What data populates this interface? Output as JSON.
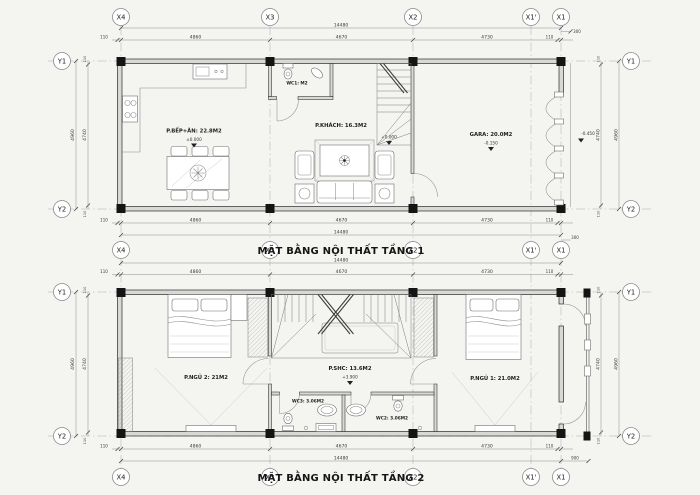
{
  "drawing": {
    "floor1": {
      "title": "MẶT BẰNG NỘI THẤT TẦNG 1",
      "rooms": {
        "kitchen": {
          "label": "P.BẾP+ĂN: 22.8M2",
          "elevation": "±0.000"
        },
        "wc1": {
          "label": "WC1: M2"
        },
        "living": {
          "label": "P.KHÁCH: 16.3M2",
          "elevation": "+0.000"
        },
        "garage": {
          "label": "GARA: 20.0M2",
          "elevation": "-0.150"
        }
      },
      "outside_elevation": "-0.450",
      "front_offset": "300"
    },
    "floor2": {
      "title": "MẶT BẰNG NỘI THẤT TẦNG 2",
      "rooms": {
        "bedroom2": {
          "label": "P.NGỦ 2: 21M2"
        },
        "family": {
          "label": "P.SHC: 13.6M2",
          "elevation": "+3.900"
        },
        "wc3": {
          "label": "WC3: 3.06M2"
        },
        "wc2": {
          "label": "WC2: 3.06M2"
        },
        "bedroom1": {
          "label": "P.NGỦ 1: 21.0M2"
        }
      },
      "balcony_offset": "900"
    },
    "grid": {
      "x_axes": [
        "X4",
        "X3",
        "X2",
        "X1'",
        "X1"
      ],
      "y_axes": [
        "Y1",
        "Y2"
      ]
    },
    "dims": {
      "total_width": "14480",
      "edge": "110",
      "bay1": "4860",
      "bay2": "4670",
      "bay3": "4730",
      "depth_total": "4960",
      "depth_inner": "4740"
    }
  }
}
